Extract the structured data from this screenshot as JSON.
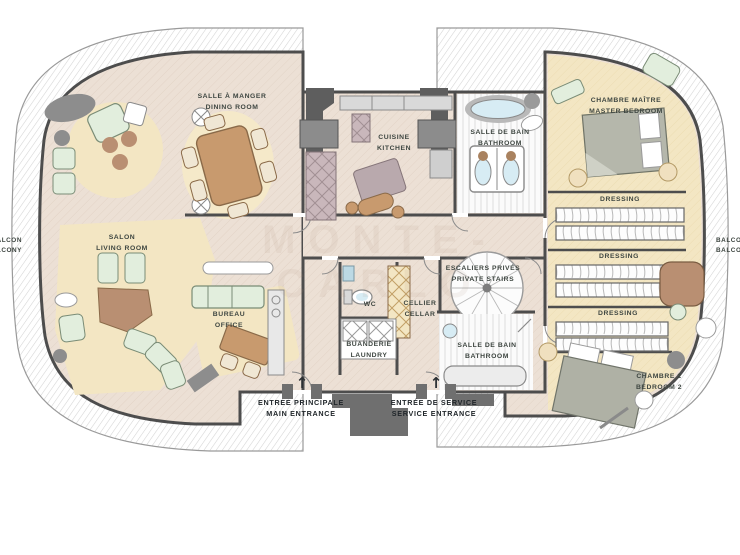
{
  "watermark": "MONTE-CARLO",
  "rooms": {
    "dining": {
      "fr": "SALLE À MANGER",
      "en": "DINING ROOM"
    },
    "kitchen": {
      "fr": "CUISINE",
      "en": "KITCHEN"
    },
    "bathroom_top": {
      "fr": "SALLE DE BAIN",
      "en": "BATHROOM"
    },
    "master_bedroom": {
      "fr": "CHAMBRE MAÎTRE",
      "en": "MASTER BEDROOM"
    },
    "dressing_1": {
      "label": "DRESSING"
    },
    "dressing_2": {
      "label": "DRESSING"
    },
    "dressing_3": {
      "label": "DRESSING"
    },
    "living_room": {
      "fr": "SALON",
      "en": "LIVING ROOM"
    },
    "office": {
      "fr": "BUREAU",
      "en": "OFFICE"
    },
    "wc": {
      "label": "WC"
    },
    "cellar": {
      "fr": "CELLIER",
      "en": "CELLAR"
    },
    "private_stairs": {
      "fr": "ESCALIERS PRIVÉS",
      "en": "PRIVATE STAIRS"
    },
    "laundry": {
      "fr": "BUANDERIE",
      "en": "LAUNDRY"
    },
    "bathroom_bottom": {
      "fr": "SALLE DE BAIN",
      "en": "BATHROOM"
    },
    "bedroom_2": {
      "fr": "CHAMBRE 2",
      "en": "BEDROOM 2"
    },
    "balcony_left": {
      "fr": "BALCON",
      "en": "BALCONY"
    },
    "balcony_right": {
      "fr": "BALCON",
      "en": "BALCONY"
    }
  },
  "entrances": {
    "main": {
      "fr": "ENTREE PRINCIPALE",
      "en": "MAIN ENTRANCE",
      "arrow": "↑"
    },
    "service": {
      "fr": "ENTRÉE DE SERVICE",
      "en": "SERVICE ENTRANCE",
      "arrow": "↑"
    }
  },
  "colors": {
    "floor": "#ece0d5",
    "carpet": "#f3e6c3",
    "wall": "#4d4d4d",
    "wood": "#c0946c",
    "mint": "#e2eedd",
    "mauve": "#c9b7bb",
    "bath_blue": "#d7ecf4",
    "text": "#3e4641"
  }
}
